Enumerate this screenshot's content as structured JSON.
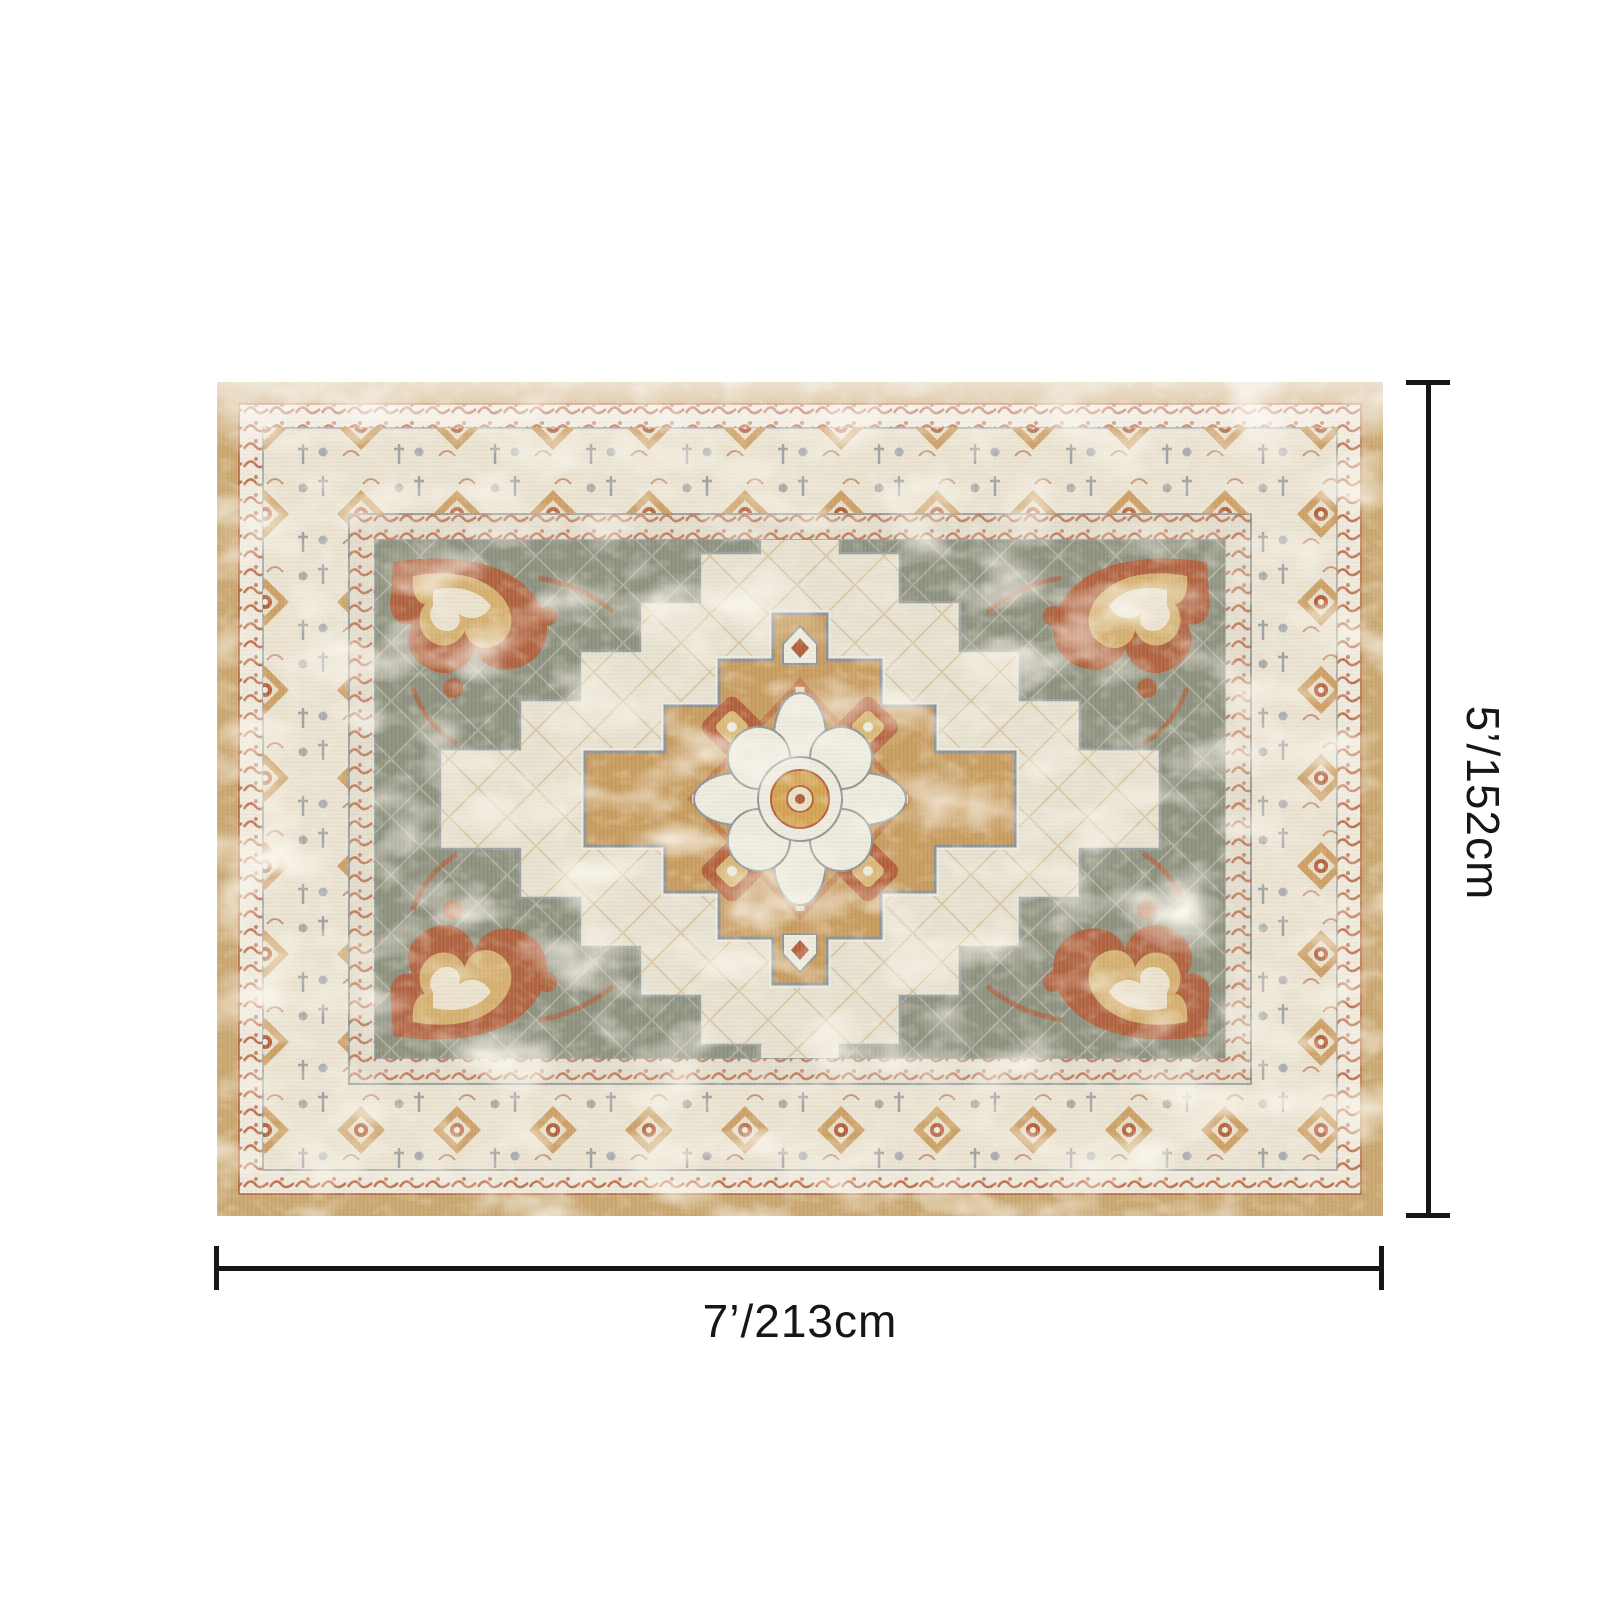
{
  "product": {
    "name": "vintage persian medallion area rug",
    "dimensions": {
      "height_label": "5’/152cm",
      "width_label": "7’/213cm"
    }
  },
  "colors": {
    "annotation": "#161616",
    "page_bg": "#ffffff",
    "tan_edge": "#c9a771",
    "guard_bg": "#efe9dc",
    "cream_border": "#eae3d2",
    "guard2_bg": "#e4ddce",
    "sage_field": "#8e9180",
    "ivory": "#edeade",
    "cream_medallion": "#e7e1d1",
    "camel": "#c79c60",
    "rust": "#b2603c",
    "gold": "#d9b878",
    "gold_center": "#d2a352",
    "outline_gray": "#8d9398"
  }
}
